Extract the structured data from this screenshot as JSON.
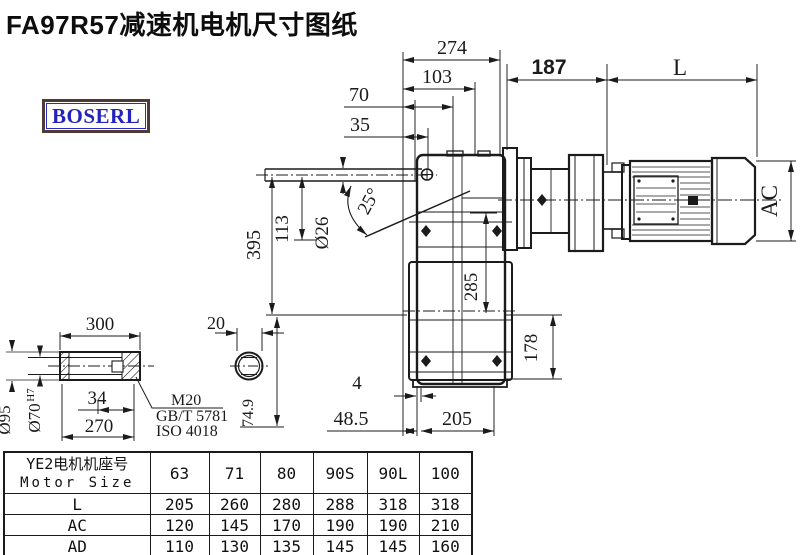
{
  "title": "FA97R57减速机电机尺寸图纸",
  "logo": {
    "text": "BOSERL"
  },
  "colors": {
    "line": "#1b1b1b",
    "logo_blue": "#2424bd",
    "logo_border": "#4e3a36"
  },
  "drawing": {
    "dims": {
      "w274": "274",
      "w103": "103",
      "w70": "70",
      "w35": "35",
      "w187": "187",
      "L": "L",
      "AC": "AC",
      "h395": "395",
      "h113": "113",
      "bore26": "Ø26",
      "angle25": "25°",
      "h285": "285",
      "h178": "178",
      "w205": "205",
      "w4": "4",
      "w48_5": "48.5",
      "s300": "300",
      "s34": "34",
      "s270": "270",
      "s95": "Ø95",
      "s70": "Ø70",
      "s70tol": "H7",
      "m20": "M20",
      "gbt": "GB/T 5781",
      "iso": "ISO 4018",
      "s20": "20",
      "s74_9": "74.9"
    }
  },
  "table": {
    "header": {
      "cn": "YE2电机机座号",
      "en": "Motor Size"
    },
    "columns": [
      "63",
      "71",
      "80",
      "90S",
      "90L",
      "100"
    ],
    "rows": [
      {
        "label": "L",
        "values": [
          "205",
          "260",
          "280",
          "288",
          "318",
          "318"
        ]
      },
      {
        "label": "AC",
        "values": [
          "120",
          "145",
          "170",
          "190",
          "190",
          "210"
        ]
      },
      {
        "label": "AD",
        "values": [
          "110",
          "130",
          "135",
          "145",
          "145",
          "160"
        ]
      }
    ]
  }
}
